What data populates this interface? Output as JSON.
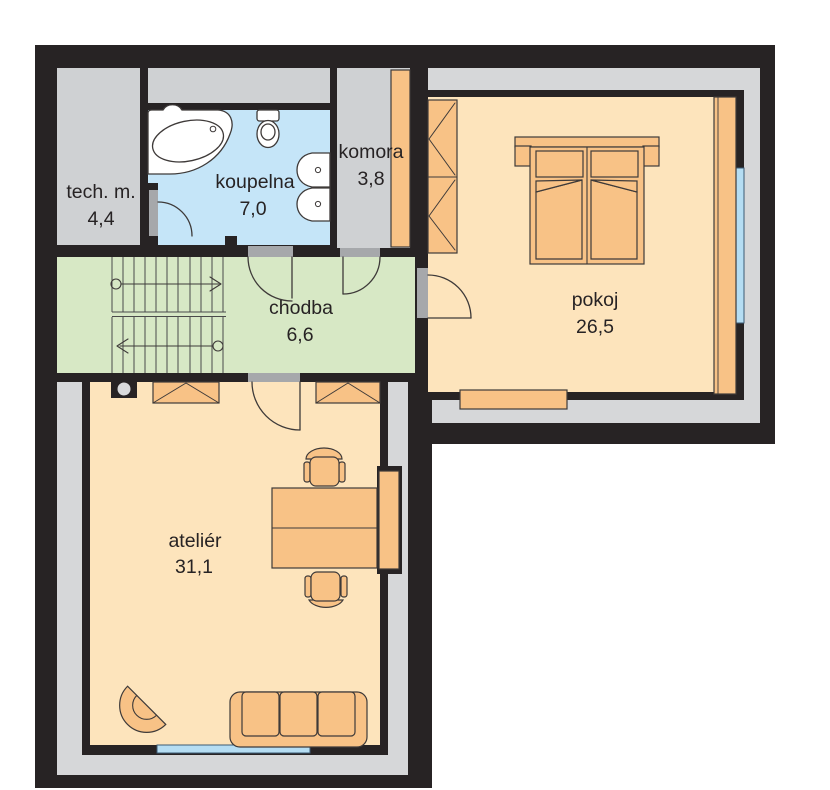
{
  "plan": {
    "title": "floor plan - upper storey",
    "rooms": [
      {
        "id": "tech-m",
        "label": "tech. m.",
        "area": "4,4"
      },
      {
        "id": "koupelna",
        "label": "koupelna",
        "area": "7,0"
      },
      {
        "id": "komora",
        "label": "komora",
        "area": "3,8"
      },
      {
        "id": "pokoj",
        "label": "pokoj",
        "area": "26,5"
      },
      {
        "id": "chodba",
        "label": "chodba",
        "area": "6,6"
      },
      {
        "id": "atelier",
        "label": "ateliér",
        "area": "31,1"
      }
    ],
    "colors": {
      "wall_black": "#272324",
      "facade_band_gray": "#d6d7d9",
      "utility_room_gray": "#cfd1d3",
      "bathroom_blue": "#c5e5f8",
      "hall_green": "#d7e8c5",
      "floor_peach": "#fde4bc",
      "furniture_orange": "#f8c286",
      "window_blue": "#b5ddf3",
      "door_jamb_gray": "#a6a8ab",
      "fixture_white": "#ffffff"
    },
    "icons": {
      "stairs": "double-flight staircase with up arrows",
      "bathtub": "corner bathtub",
      "toilet": "wc",
      "sinks": "two washbasins",
      "bed": "double bed with pillows",
      "wardrobes": "triangle-hatched closets",
      "desk": "double desk with two chairs",
      "sofa": "three-seat sofa",
      "armchair": "corner armchair",
      "chimney": "flue with round duct"
    }
  }
}
